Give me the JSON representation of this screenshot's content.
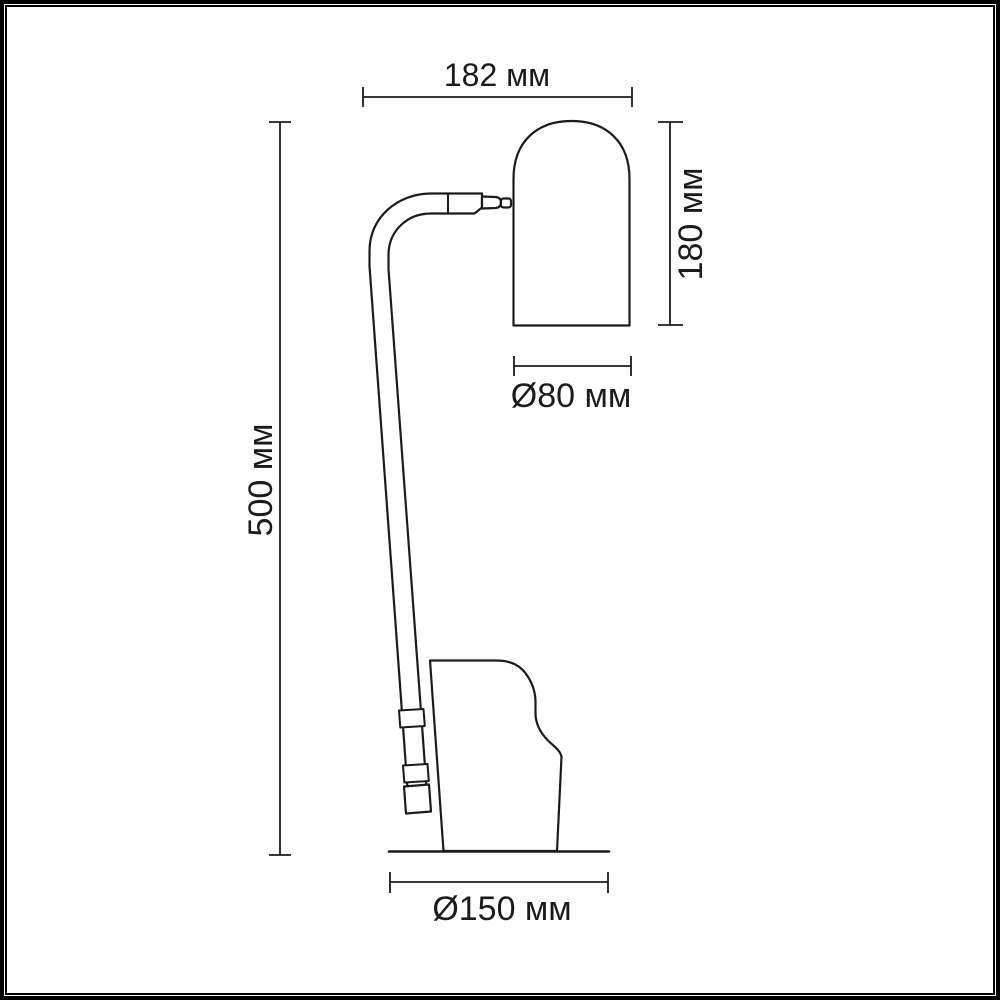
{
  "diagram": {
    "type": "technical-dimension-drawing",
    "subject": "desk lamp side view with dimension callouts",
    "units": "мм",
    "colors": {
      "line": "#1b1b1b",
      "background": "#ffffff",
      "frame": "#000000"
    },
    "labels": {
      "head_width": "182 мм",
      "head_height": "180 мм",
      "shade_diameter": "Ø80 мм",
      "total_height": "500 мм",
      "base_diameter": "Ø150 мм"
    },
    "measurements": [
      {
        "name": "overall width",
        "label": "182 мм",
        "value_mm": 182
      },
      {
        "name": "shade height",
        "label": "180 мм",
        "value_mm": 180
      },
      {
        "name": "shade diameter",
        "label": "Ø80 мм",
        "value_mm": 80
      },
      {
        "name": "total height",
        "label": "500 мм",
        "value_mm": 500
      },
      {
        "name": "base diameter",
        "label": "Ø150 мм",
        "value_mm": 150
      }
    ]
  }
}
